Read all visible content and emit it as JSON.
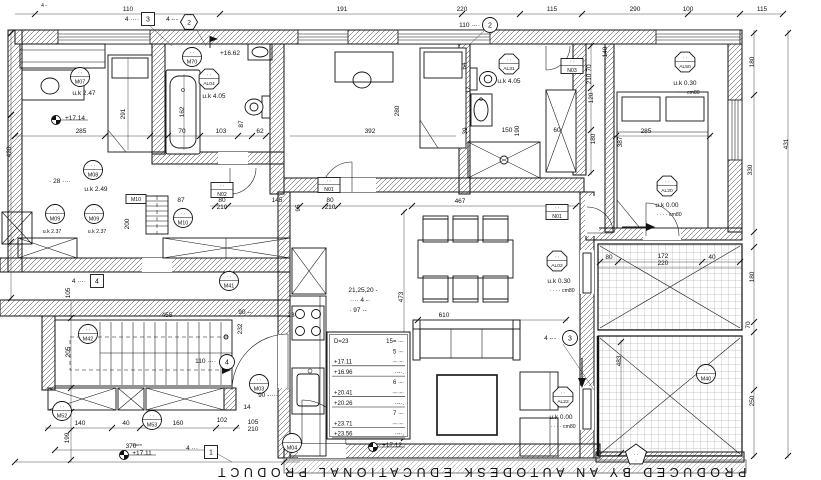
{
  "document": {
    "watermark": "PRODUCED BY AN AUTODESK EDUCATIONAL PRODUCT"
  },
  "colors": {
    "ink": "#111111",
    "paper": "#ffffff",
    "hatch": "#333333",
    "tile_line": "#666666"
  },
  "annotations": [
    {
      "t": "110",
      "x": 128,
      "y": 11
    },
    {
      "t": "191",
      "x": 342,
      "y": 11
    },
    {
      "t": "220",
      "x": 462,
      "y": 11
    },
    {
      "t": "115",
      "x": 552,
      "y": 11
    },
    {
      "t": "290",
      "x": 635,
      "y": 11
    },
    {
      "t": "100",
      "x": 688,
      "y": 11
    },
    {
      "t": "115",
      "x": 762,
      "y": 11
    },
    {
      "t": "4 -",
      "x": 44,
      "y": 7,
      "s": 5
    },
    {
      "t": "4 ····",
      "x": 139,
      "y": 21,
      "a": "end"
    },
    {
      "t": "4 -·-",
      "x": 178,
      "y": 21,
      "a": "end"
    },
    {
      "t": "110 ·-··",
      "x": 480,
      "y": 27,
      "a": "end"
    },
    {
      "t": "+16.62",
      "x": 230,
      "y": 55
    },
    {
      "t": "+17.14",
      "x": 75,
      "y": 120
    },
    {
      "t": "+17.11",
      "x": 142,
      "y": 455
    },
    {
      "t": "35cm",
      "x": 137,
      "y": 446,
      "s": 4
    },
    {
      "t": "+17.12",
      "x": 392,
      "y": 447
    },
    {
      "t": "u.k  2.47",
      "x": 84,
      "y": 95
    },
    {
      "t": "285",
      "x": 81,
      "y": 133
    },
    {
      "t": "291",
      "x": 125,
      "y": 114,
      "r": -90
    },
    {
      "t": "162",
      "x": 184,
      "y": 112,
      "r": -90
    },
    {
      "t": "70",
      "x": 182,
      "y": 133
    },
    {
      "t": "103",
      "x": 221,
      "y": 133
    },
    {
      "t": "87",
      "x": 243,
      "y": 124,
      "r": -90
    },
    {
      "t": "62",
      "x": 260,
      "y": 133
    },
    {
      "t": "u.k  4.05",
      "x": 214,
      "y": 98
    },
    {
      "t": "· 28 ····",
      "x": 60,
      "y": 183
    },
    {
      "t": "u.k  2.49",
      "x": 96,
      "y": 191
    },
    {
      "t": "u.k  2.37",
      "x": 52,
      "y": 233,
      "s": 5.2
    },
    {
      "t": "u.k  2.37",
      "x": 97,
      "y": 233,
      "s": 5.2
    },
    {
      "t": "87",
      "x": 181,
      "y": 202
    },
    {
      "t": "80",
      "x": 222,
      "y": 202
    },
    {
      "t": "210",
      "x": 222,
      "y": 209
    },
    {
      "t": "145",
      "x": 277,
      "y": 202
    },
    {
      "t": "200",
      "x": 129,
      "y": 224,
      "r": -90
    },
    {
      "t": "392",
      "x": 370,
      "y": 133
    },
    {
      "t": "280",
      "x": 399,
      "y": 111,
      "r": -90
    },
    {
      "t": "u.k  4.05",
      "x": 509,
      "y": 83
    },
    {
      "t": "64",
      "x": 466,
      "y": 66,
      "r": -90
    },
    {
      "t": "17",
      "x": 470,
      "y": 90,
      "r": -90
    },
    {
      "t": "39",
      "x": 467,
      "y": 131,
      "r": -90
    },
    {
      "t": "150",
      "x": 507,
      "y": 132
    },
    {
      "t": "190",
      "x": 519,
      "y": 131,
      "r": -90
    },
    {
      "t": "60",
      "x": 557,
      "y": 132
    },
    {
      "t": "70",
      "x": 591,
      "y": 68,
      "r": -90
    },
    {
      "t": "210",
      "x": 591,
      "y": 79,
      "r": -90
    },
    {
      "t": "120",
      "x": 593,
      "y": 98,
      "r": -90
    },
    {
      "t": "180",
      "x": 595,
      "y": 139,
      "r": -90
    },
    {
      "t": "u.k  0.30",
      "x": 685,
      "y": 85
    },
    {
      "t": "· · · ·  cm80",
      "x": 687,
      "y": 94,
      "s": 5.2
    },
    {
      "t": "285",
      "x": 646,
      "y": 133
    },
    {
      "t": "387",
      "x": 622,
      "y": 142,
      "r": -90
    },
    {
      "t": "140",
      "x": 607,
      "y": 52,
      "r": -90
    },
    {
      "t": "180",
      "x": 754,
      "y": 62,
      "r": -90
    },
    {
      "t": "431",
      "x": 788,
      "y": 144,
      "r": -90
    },
    {
      "t": "330",
      "x": 752,
      "y": 170,
      "r": -90
    },
    {
      "t": "180",
      "x": 754,
      "y": 277,
      "r": -90
    },
    {
      "t": "70",
      "x": 750,
      "y": 325,
      "r": -90
    },
    {
      "t": "250",
      "x": 754,
      "y": 401,
      "r": -90
    },
    {
      "t": "420",
      "x": 11,
      "y": 152,
      "r": -90
    },
    {
      "t": "80",
      "x": 330,
      "y": 202
    },
    {
      "t": "210",
      "x": 330,
      "y": 209
    },
    {
      "t": "95",
      "x": 300,
      "y": 208,
      "r": -90
    },
    {
      "t": "467",
      "x": 460,
      "y": 203
    },
    {
      "t": "473",
      "x": 403,
      "y": 297,
      "r": -90
    },
    {
      "t": "610",
      "x": 444,
      "y": 317
    },
    {
      "t": "u.k  0.00",
      "x": 667,
      "y": 207
    },
    {
      "t": "· · · ·  cm80",
      "x": 669,
      "y": 216,
      "s": 5.2
    },
    {
      "t": "80",
      "x": 609,
      "y": 259
    },
    {
      "t": "172",
      "x": 663,
      "y": 258
    },
    {
      "t": "220",
      "x": 663,
      "y": 265
    },
    {
      "t": "40",
      "x": 712,
      "y": 259
    },
    {
      "t": "u.k  0.30",
      "x": 559,
      "y": 283
    },
    {
      "t": "· · · ·  cm80",
      "x": 562,
      "y": 292,
      "s": 5.2
    },
    {
      "t": "4 -·-",
      "x": 556,
      "y": 340,
      "a": "end"
    },
    {
      "t": "u.k  0.00",
      "x": 561,
      "y": 419
    },
    {
      "t": "· · · ·  cm80",
      "x": 563,
      "y": 428,
      "s": 5.2
    },
    {
      "t": "483",
      "x": 621,
      "y": 361,
      "r": -90
    },
    {
      "t": "4 ····",
      "x": 86,
      "y": 283,
      "a": "end"
    },
    {
      "t": "105",
      "x": 70,
      "y": 293,
      "r": -90
    },
    {
      "t": "205",
      "x": 70,
      "y": 352,
      "r": -90
    },
    {
      "t": "455",
      "x": 167,
      "y": 317
    },
    {
      "t": "90 --·",
      "x": 246,
      "y": 314
    },
    {
      "t": "110 ·-··",
      "x": 216,
      "y": 363,
      "a": "end"
    },
    {
      "t": "232",
      "x": 242,
      "y": 329,
      "r": -90
    },
    {
      "t": "23",
      "x": 291,
      "y": 317
    },
    {
      "t": "21,25,20 -",
      "x": 363,
      "y": 292
    },
    {
      "t": "···· 4 -·",
      "x": 360,
      "y": 302
    },
    {
      "t": "· 97 ·-",
      "x": 358,
      "y": 312
    },
    {
      "t": "140",
      "x": 80,
      "y": 425
    },
    {
      "t": "40",
      "x": 126,
      "y": 425
    },
    {
      "t": "160",
      "x": 178,
      "y": 425
    },
    {
      "t": "102",
      "x": 222,
      "y": 422
    },
    {
      "t": "14",
      "x": 247,
      "y": 409
    },
    {
      "t": "105",
      "x": 253,
      "y": 424
    },
    {
      "t": "210",
      "x": 253,
      "y": 431
    },
    {
      "t": "199",
      "x": 69,
      "y": 438,
      "r": -90
    },
    {
      "t": "370",
      "x": 131,
      "y": 448
    },
    {
      "t": "90 -····",
      "x": 268,
      "y": 397
    },
    {
      "t": "4 ···",
      "x": 198,
      "y": 450,
      "a": "end"
    }
  ],
  "markers": [
    {
      "kind": "circle",
      "label": "M07",
      "x": 80,
      "y": 77
    },
    {
      "kind": "circle",
      "label": "M70",
      "x": 192,
      "y": 57
    },
    {
      "kind": "circle",
      "label": "M08",
      "x": 93,
      "y": 170
    },
    {
      "kind": "circle",
      "label": "M09",
      "x": 55,
      "y": 214
    },
    {
      "kind": "circle",
      "label": "M09",
      "x": 94,
      "y": 214
    },
    {
      "kind": "circle",
      "label": "M10",
      "x": 183,
      "y": 218
    },
    {
      "kind": "circle",
      "label": "M41",
      "x": 229,
      "y": 281
    },
    {
      "kind": "circle",
      "label": "M42",
      "x": 88,
      "y": 334
    },
    {
      "kind": "circle",
      "label": "M52",
      "x": 62,
      "y": 411
    },
    {
      "kind": "circle",
      "label": "M53",
      "x": 152,
      "y": 420
    },
    {
      "kind": "circle",
      "label": "M03",
      "x": 259,
      "y": 384
    },
    {
      "kind": "circle",
      "label": "M04",
      "x": 292,
      "y": 443
    },
    {
      "kind": "circle",
      "label": "M40",
      "x": 706,
      "y": 374
    },
    {
      "kind": "octagon",
      "label": "AL04",
      "x": 209,
      "y": 79
    },
    {
      "kind": "octagon",
      "label": "AL31",
      "x": 509,
      "y": 64
    },
    {
      "kind": "octagon",
      "label": "AL50",
      "x": 685,
      "y": 62
    },
    {
      "kind": "octagon",
      "label": "AL20",
      "x": 667,
      "y": 186
    },
    {
      "kind": "octagon",
      "label": "AL02",
      "x": 557,
      "y": 261
    },
    {
      "kind": "octagon",
      "label": "AL22",
      "x": 563,
      "y": 397
    },
    {
      "kind": "box",
      "label": "N01",
      "x": 329,
      "y": 185
    },
    {
      "kind": "box",
      "label": "N01",
      "x": 557,
      "y": 212
    },
    {
      "kind": "box",
      "label": "N02",
      "x": 222,
      "y": 190
    },
    {
      "kind": "box",
      "label": "N03",
      "x": 572,
      "y": 66
    },
    {
      "kind": "mbox",
      "label": "M10",
      "x": 136,
      "y": 199
    },
    {
      "kind": "dbox",
      "label": "3",
      "x": 148,
      "y": 19
    },
    {
      "kind": "dbox",
      "label": "4",
      "x": 97,
      "y": 281
    },
    {
      "kind": "dbox",
      "label": "1",
      "x": 211,
      "y": 452
    },
    {
      "kind": "dcirc",
      "label": "2",
      "x": 490,
      "y": 25
    },
    {
      "kind": "dcirc",
      "label": "4",
      "x": 227,
      "y": 362
    },
    {
      "kind": "dcirc",
      "label": "3",
      "x": 570,
      "y": 338
    },
    {
      "kind": "hex",
      "label": "2",
      "x": 189,
      "y": 22
    },
    {
      "kind": "pent",
      "label": "· ·",
      "x": 636,
      "y": 455
    },
    {
      "kind": "level",
      "label": "",
      "x": 56,
      "y": 120
    },
    {
      "kind": "level",
      "label": "",
      "x": 124,
      "y": 455
    },
    {
      "kind": "level",
      "label": "",
      "x": 373,
      "y": 447
    },
    {
      "kind": "flag",
      "label": "",
      "x": 210,
      "y": 48
    }
  ],
  "stair_table": {
    "rows": [
      {
        "l": "D=23",
        "r": "15= ·-·",
        "u": false
      },
      {
        "l": "",
        "r": "5 ·-·",
        "u": false
      },
      {
        "l": "+17.11",
        "r": "·-··-·",
        "u": true
      },
      {
        "l": "+16.96",
        "r": "··-·.",
        "u": true
      },
      {
        "l": "",
        "r": "6 ·-·",
        "u": false
      },
      {
        "l": "+20.41",
        "r": "·-··-·",
        "u": true
      },
      {
        "l": "+20.26",
        "r": "··-·.",
        "u": true
      },
      {
        "l": "",
        "r": "7 ·-·",
        "u": false
      },
      {
        "l": "+23.71",
        "r": "·-··-·",
        "u": true
      },
      {
        "l": "+23.56",
        "r": "··-·.",
        "u": true
      }
    ]
  }
}
